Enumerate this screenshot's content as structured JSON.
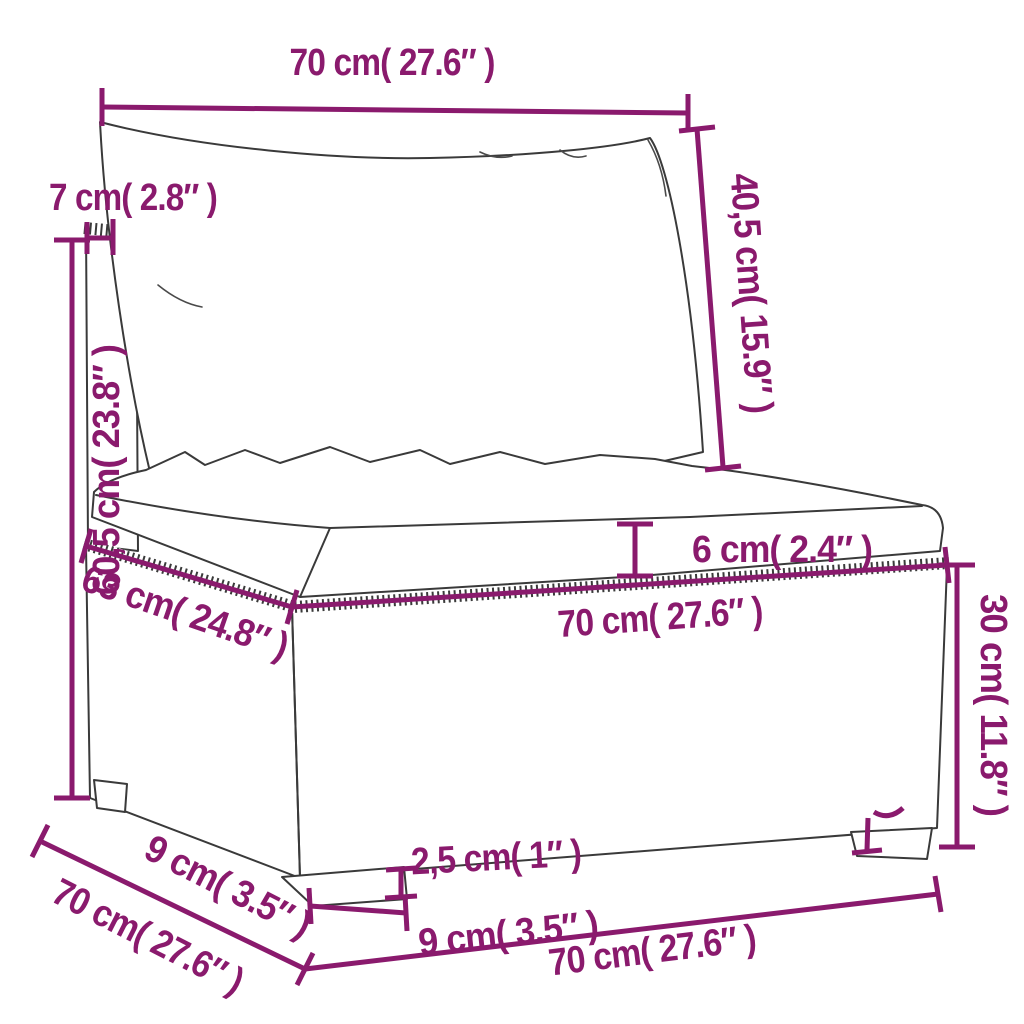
{
  "colors": {
    "dimension": "#8a1a6d",
    "line_art": "#3a3a3a",
    "background": "#ffffff"
  },
  "diagram": {
    "dimensions": {
      "back_cushion_width": "70 cm( 27.6″ )",
      "back_panel_thickness": "7 cm( 2.8″ )",
      "back_cushion_height": "40,5 cm( 15.9″ )",
      "total_height": "60,5 cm( 23.8″ )",
      "seat_cushion_thickness": "6 cm( 2.4″ )",
      "seat_depth": "63 cm( 24.8″ )",
      "seat_width": "70 cm( 27.6″ )",
      "base_height": "30 cm( 11.8″ )",
      "leg_height": "2,5 cm( 1″ )",
      "leg_depth": "9 cm( 3.5″ )",
      "total_depth": "70 cm( 27.6″ )",
      "leg_width": "9 cm( 3.5″ )",
      "total_width": "70 cm( 27.6″ )"
    }
  }
}
